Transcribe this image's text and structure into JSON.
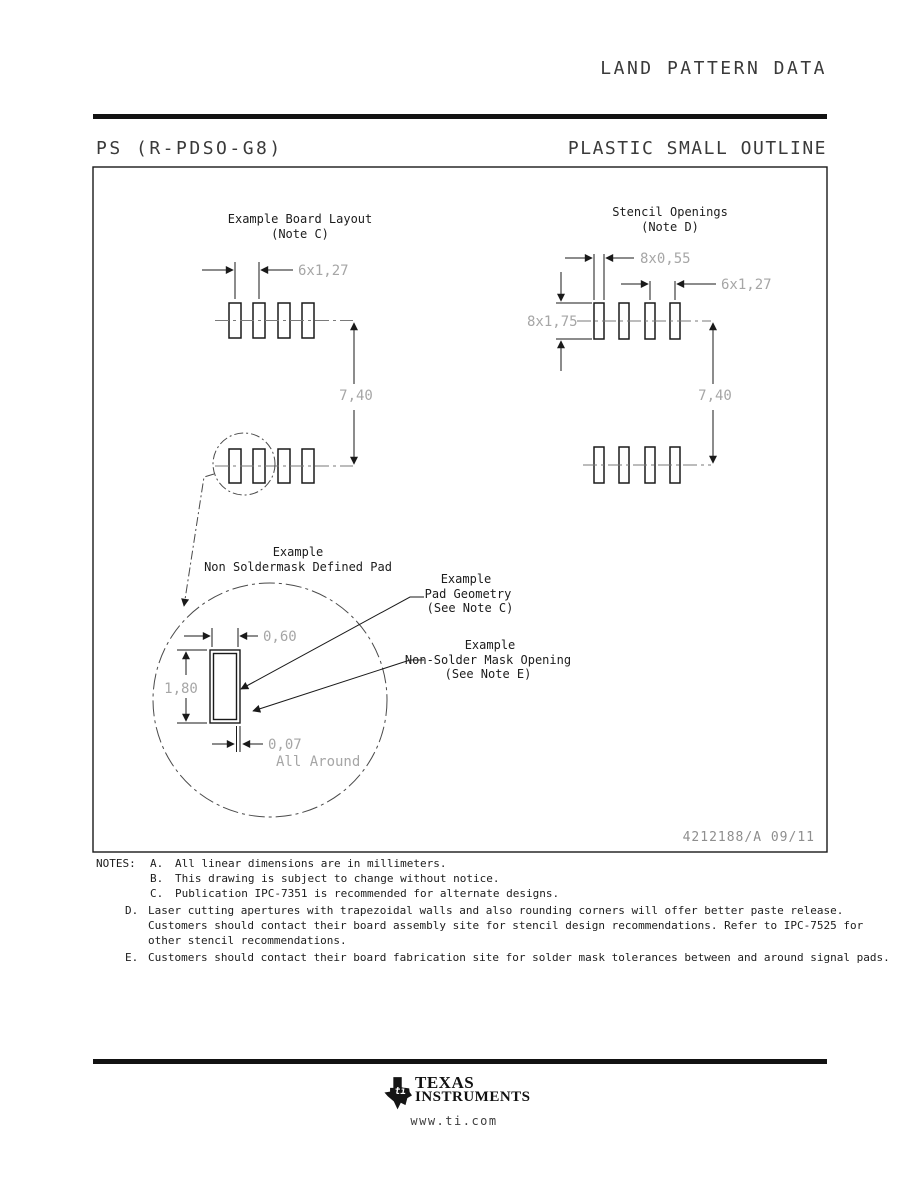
{
  "page": {
    "title": "LAND PATTERN DATA",
    "package_code": "PS (R-PDSO-G8)",
    "package_type": "PLASTIC SMALL OUTLINE",
    "doc_number": "4212188/A  09/11"
  },
  "board_layout": {
    "title": "Example Board Layout",
    "subtitle": "(Note C)",
    "dim_pitch": "6x1,27",
    "dim_row_spacing": "7,40"
  },
  "stencil": {
    "title": "Stencil Openings",
    "subtitle": "(Note D)",
    "dim_width": "8x0,55",
    "dim_pitch": "6x1,27",
    "dim_height": "8x1,75",
    "dim_row_spacing": "7,40"
  },
  "detail": {
    "label_line1": "Example",
    "label_line2": "Non Soldermask Defined Pad",
    "pad_label_line1": "Example",
    "pad_label_line2": "Pad Geometry",
    "pad_label_line3": "(See Note C)",
    "mask_label_line1": "Example",
    "mask_label_line2": "Non-Solder Mask Opening",
    "mask_label_line3": "(See Note E)",
    "dim_pad_width": "0,60",
    "dim_pad_height": "1,80",
    "dim_mask_clearance": "0,07",
    "dim_mask_clearance_note": "All Around"
  },
  "notes": {
    "heading": "NOTES:",
    "items": [
      {
        "letter": "A.",
        "text": "All linear dimensions are in millimeters."
      },
      {
        "letter": "B.",
        "text": "This drawing is subject to change without notice."
      },
      {
        "letter": "C.",
        "text": "Publication IPC-7351 is recommended for alternate designs."
      },
      {
        "letter": "D.",
        "text": "Laser cutting apertures with trapezoidal walls and also rounding corners will offer better paste release.  Customers should contact their board assembly site for stencil design recommendations. Refer to IPC-7525 for other stencil recommendations."
      },
      {
        "letter": "E.",
        "text": "Customers should contact their board fabrication site for solder mask tolerances between and around signal pads."
      }
    ]
  },
  "footer": {
    "brand_line1": "TEXAS",
    "brand_line2": "INSTRUMENTS",
    "website": "www.ti.com"
  },
  "colors": {
    "line": "#1a1a1a",
    "dim_text": "#a6a6a6",
    "centerline": "#7a7a7a",
    "header_text": "#3a3a3a"
  }
}
